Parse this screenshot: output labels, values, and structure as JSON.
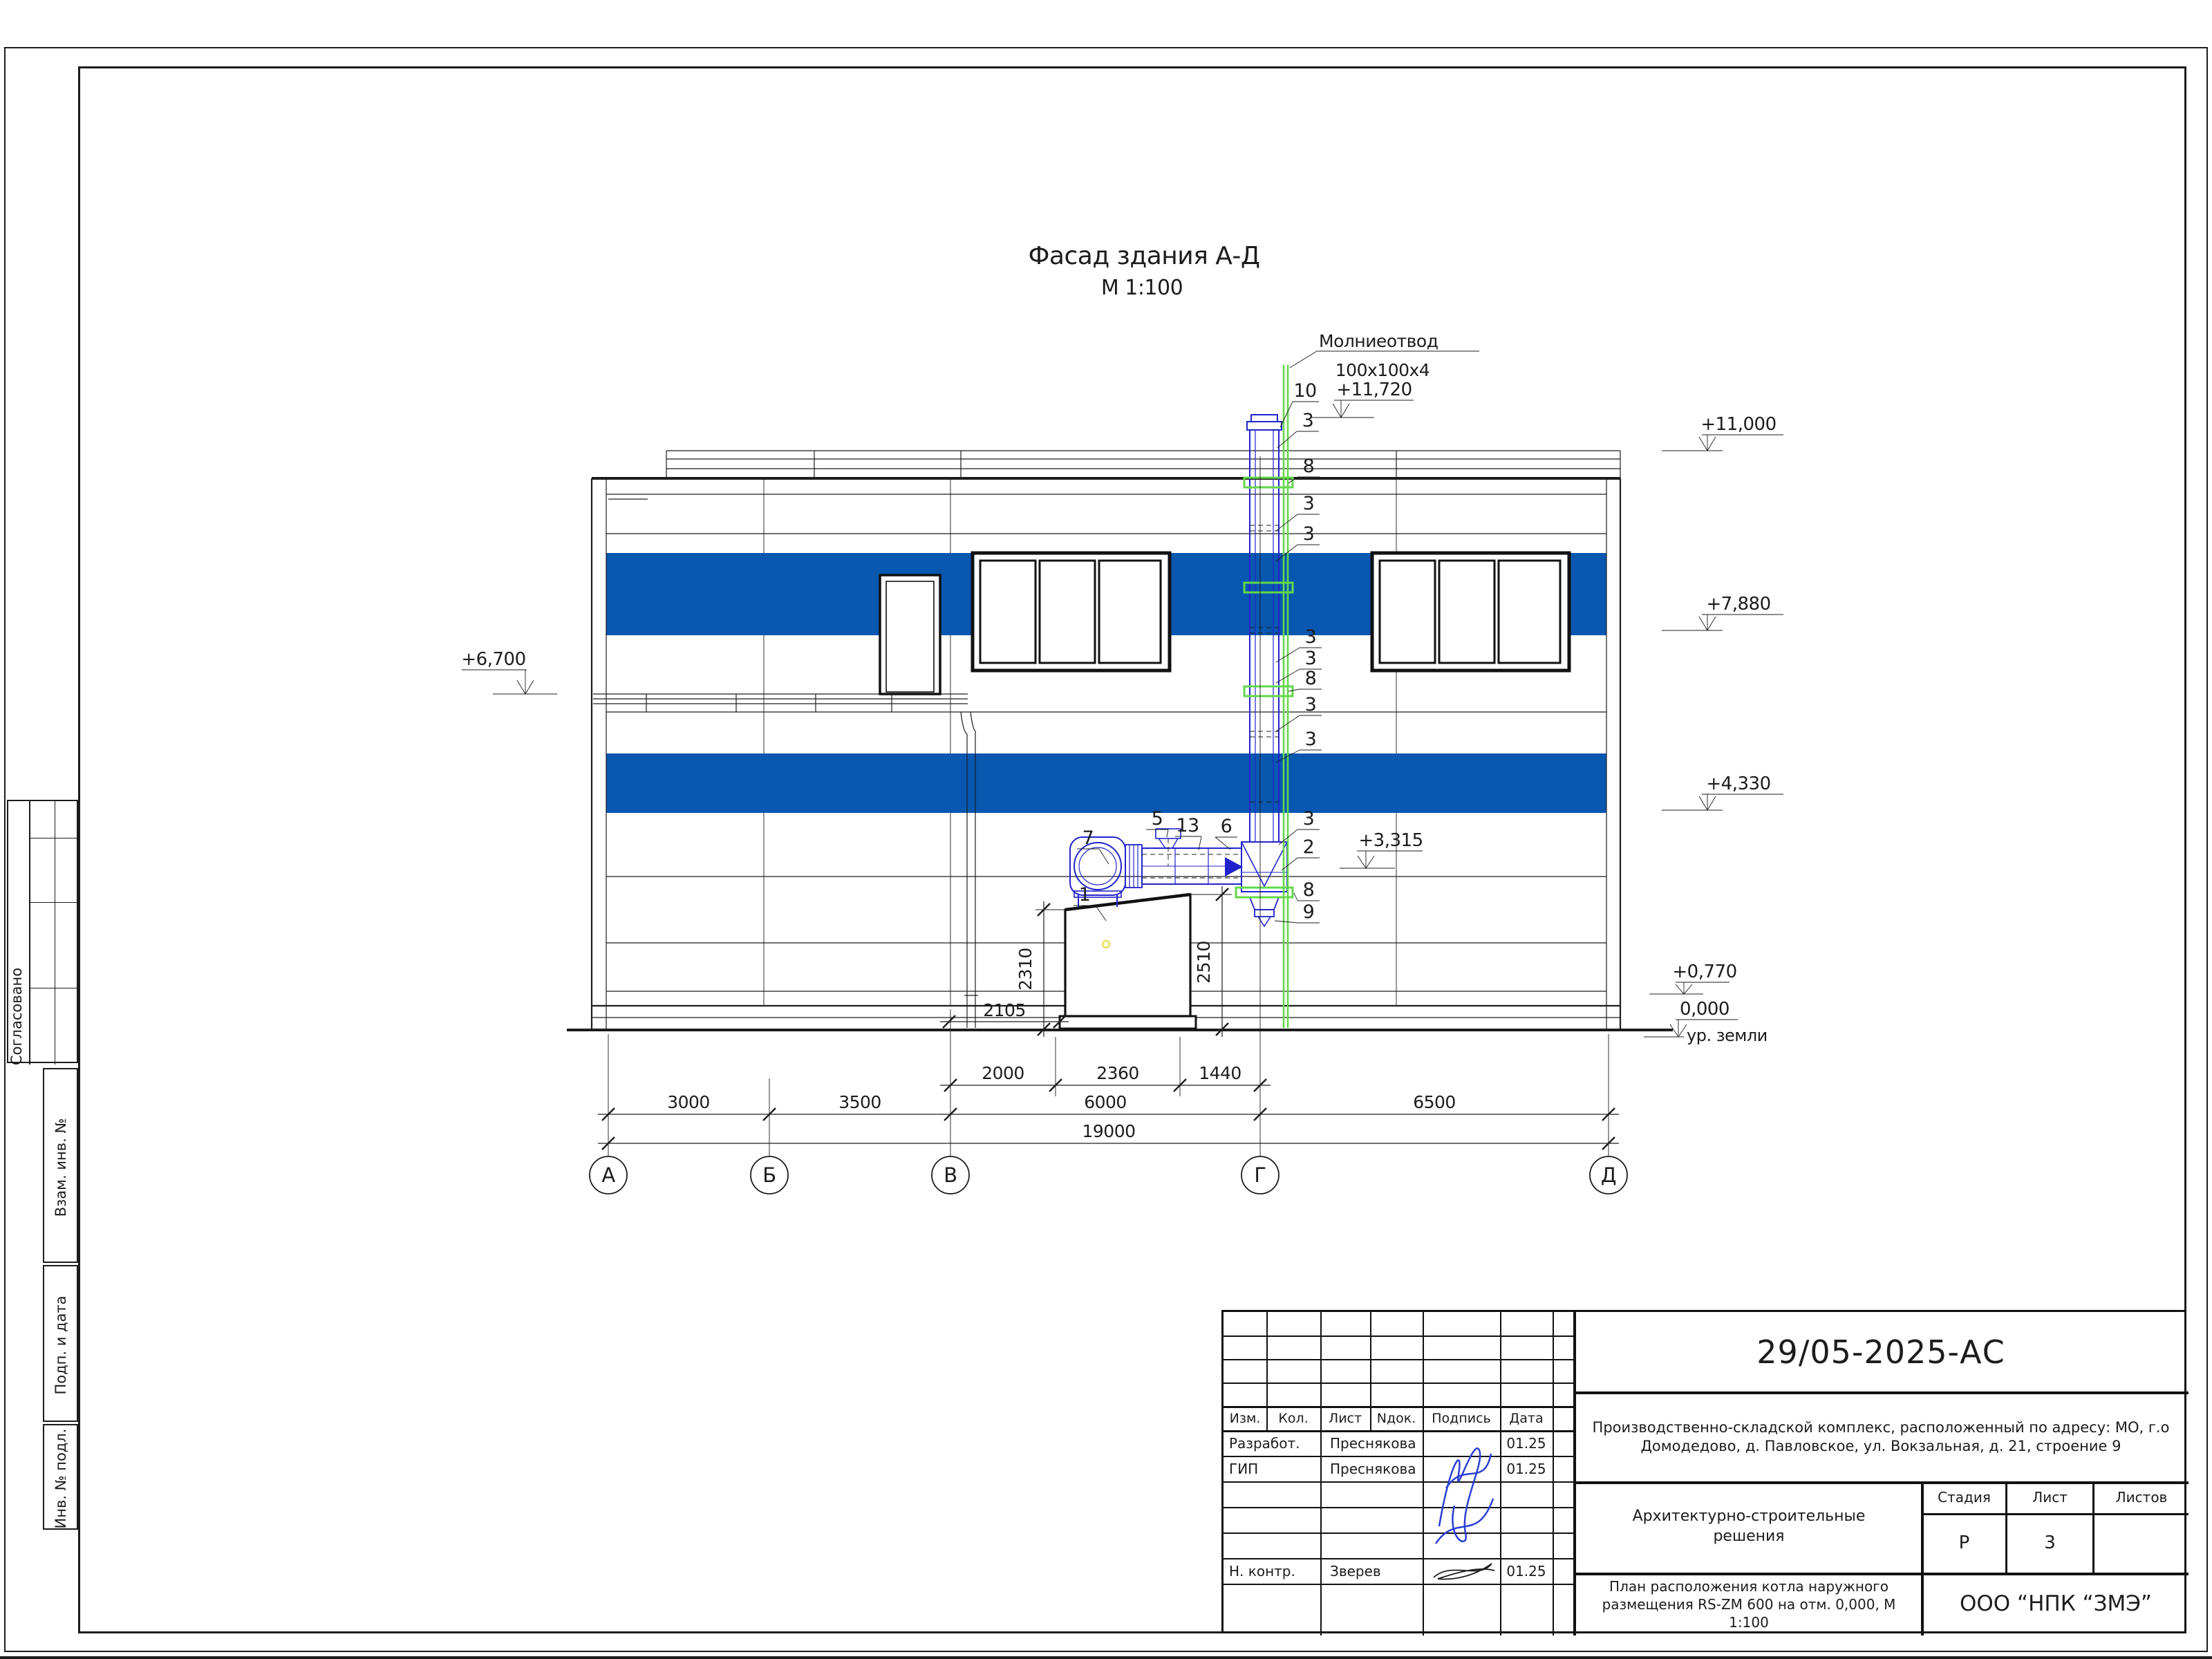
{
  "sheet": {
    "drawing_title": "Фасад здания А-Д",
    "drawing_scale": "М 1:100"
  },
  "annotations": {
    "lightning_rod": "Молниеотвод",
    "lightning_rod_size": "100х100х4",
    "ground_label": "ур. земли"
  },
  "elevations": {
    "e11720": "+11,720",
    "e11000": "+11,000",
    "e7880": "+7,880",
    "e6700": "+6,700",
    "e4330": "+4,330",
    "e3315": "+3,315",
    "e0770": "+0,770",
    "e0000": "0,000"
  },
  "dimensions": {
    "d2000": "2000",
    "d2360": "2360",
    "d1440": "1440",
    "d3000": "3000",
    "d3500": "3500",
    "d6000": "6000",
    "d6500": "6500",
    "d19000": "19000",
    "d2310": "2310",
    "d2510": "2510",
    "d2105": "2105"
  },
  "axes": {
    "a": "А",
    "b": "Б",
    "v": "В",
    "g": "Г",
    "d": "Д"
  },
  "callouts": {
    "n1": "1",
    "n2": "2",
    "n3": "3",
    "n5": "5",
    "n6": "6",
    "n7": "7",
    "n8": "8",
    "n9": "9",
    "n10": "10",
    "n13": "13"
  },
  "sidebar": {
    "agreed": "Согласовано",
    "vzam": "Взам. инв. №",
    "podp": "Подп. и дата",
    "inv": "Инв. № подл."
  },
  "titleblock": {
    "code": "29/05-2025-АС",
    "project": "Производственно-складской комплекс, расположенный по адресу: МО, г.о Домодедово, д. Павловское, ул. Вокзальная, д. 21, строение 9",
    "section": "Архитектурно-строительные решения",
    "sheet_title": "План расположения котла наружного размещения RS-ZM 600 на отм. 0,000,  М 1:100",
    "company": "ООО “НПК “ЗМЭ”",
    "headers": {
      "izm": "Изм.",
      "kol": "Кол.",
      "list": "Лист",
      "ndok": "Nдок.",
      "podpis": "Подпись",
      "data": "Дата",
      "stage": "Стадия",
      "sheet": "Лист",
      "sheets": "Листов"
    },
    "stage_value": "Р",
    "sheet_value": "3",
    "sheets_value": "",
    "rows": [
      {
        "role": "Разработ.",
        "name": "Преснякова",
        "date": "01.25"
      },
      {
        "role": "ГИП",
        "name": "Преснякова",
        "date": "01.25"
      },
      {
        "role": "Н. контр.",
        "name": "Зверев",
        "date": "01.25"
      }
    ]
  },
  "colors": {
    "band_blue": "#0857b0",
    "cad_blue": "#2222cc",
    "rod_green": "#63d84a",
    "signature_blue": "#2a3fd4"
  }
}
